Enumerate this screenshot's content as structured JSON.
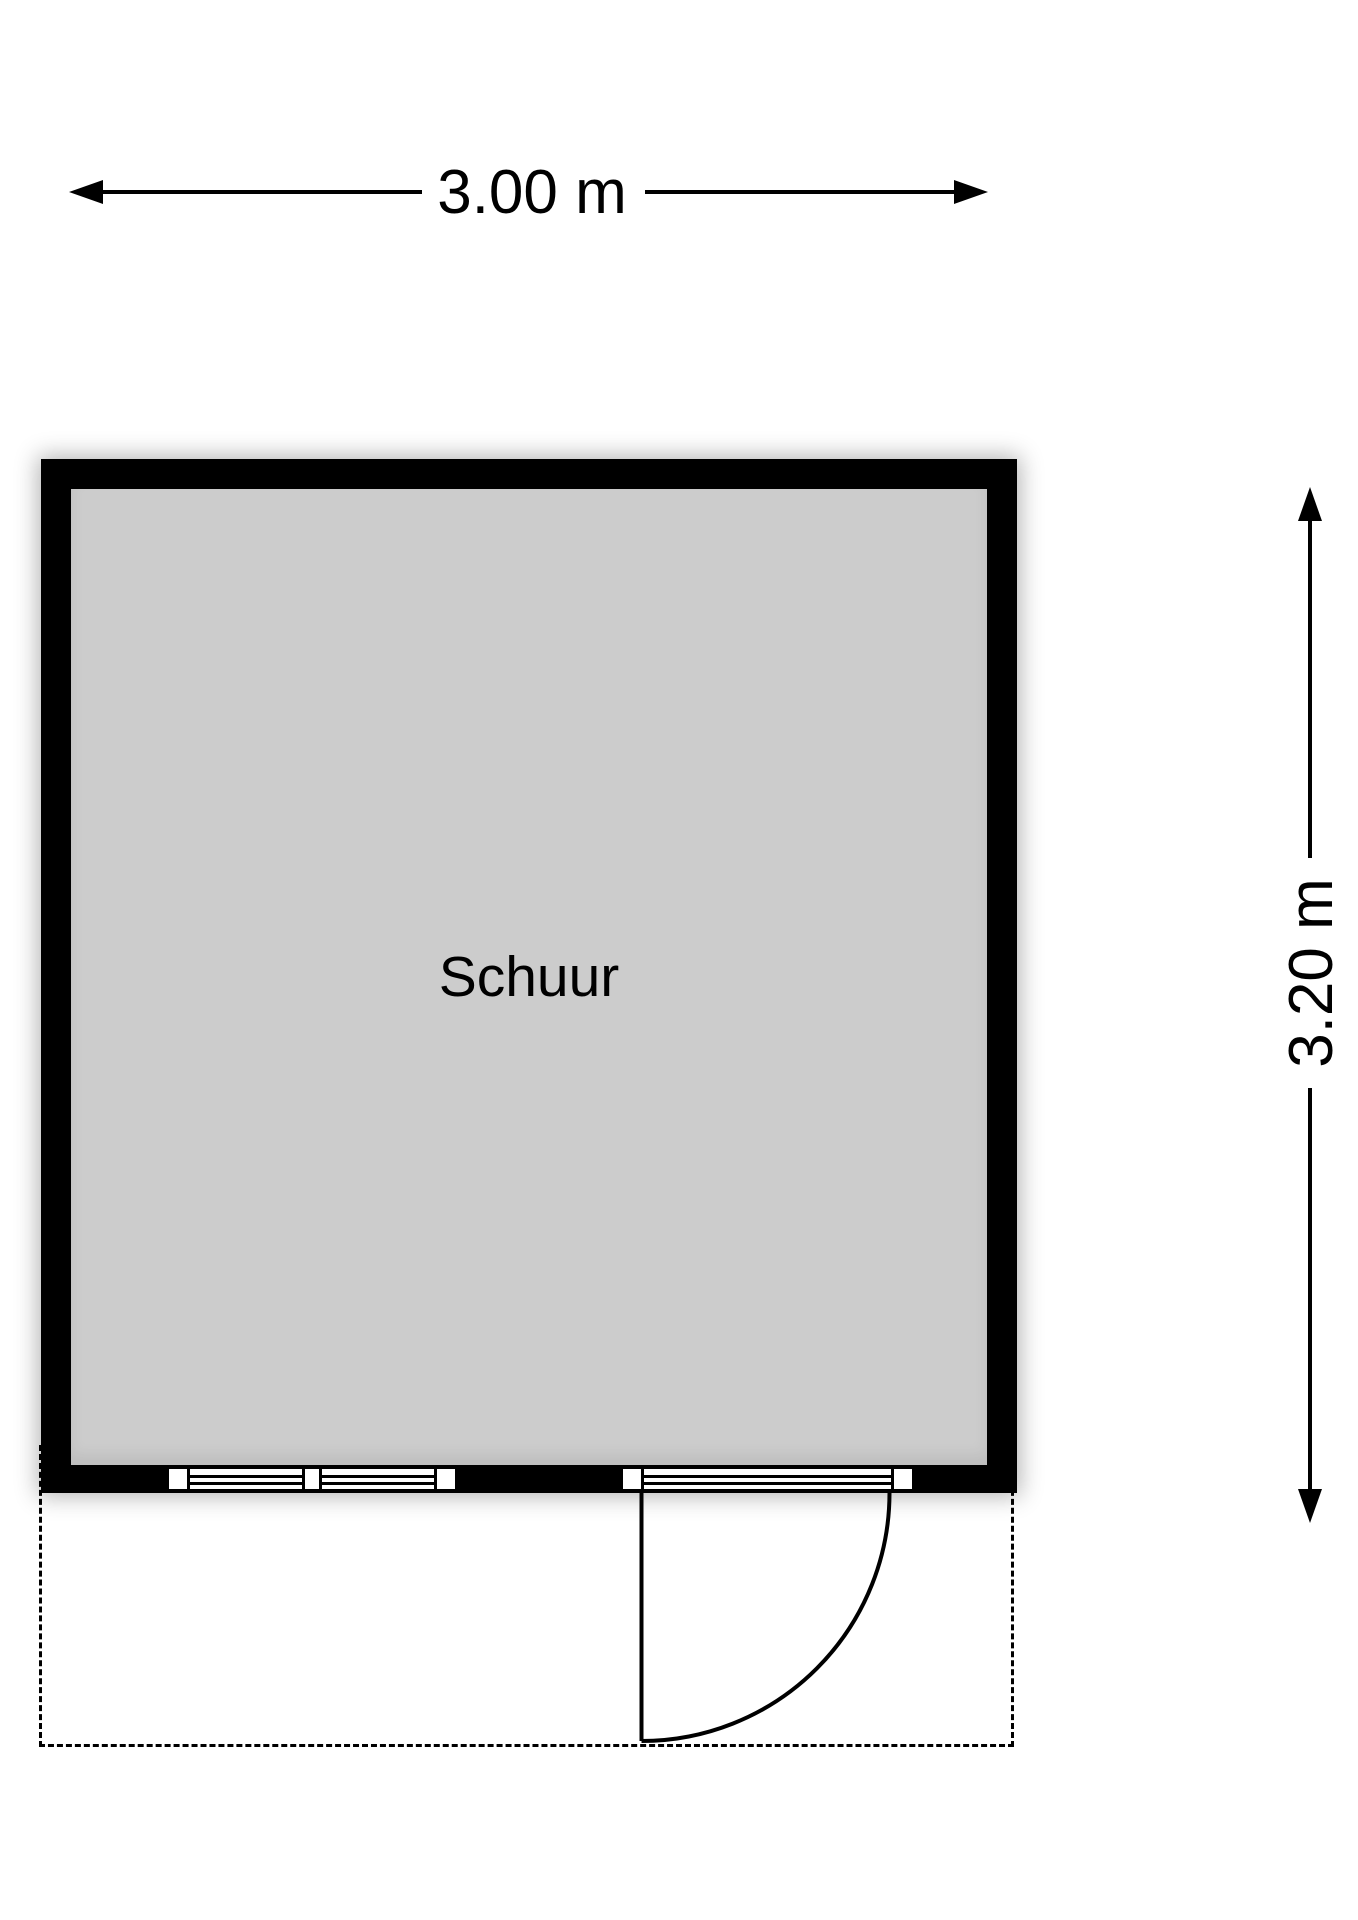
{
  "floorplan": {
    "background_color": "#ffffff",
    "room": {
      "label": "Schuur",
      "floor_color": "#cccccc",
      "wall_color": "#000000"
    },
    "dimensions": {
      "width": {
        "label": "3.00 m"
      },
      "height": {
        "label": "3.20 m"
      }
    },
    "features": {
      "window_units": 1,
      "glazed_door_units": 1,
      "door_swing": "quarter-circle, opens outward to bottom-right",
      "exterior_area_outline": "dashed"
    }
  }
}
